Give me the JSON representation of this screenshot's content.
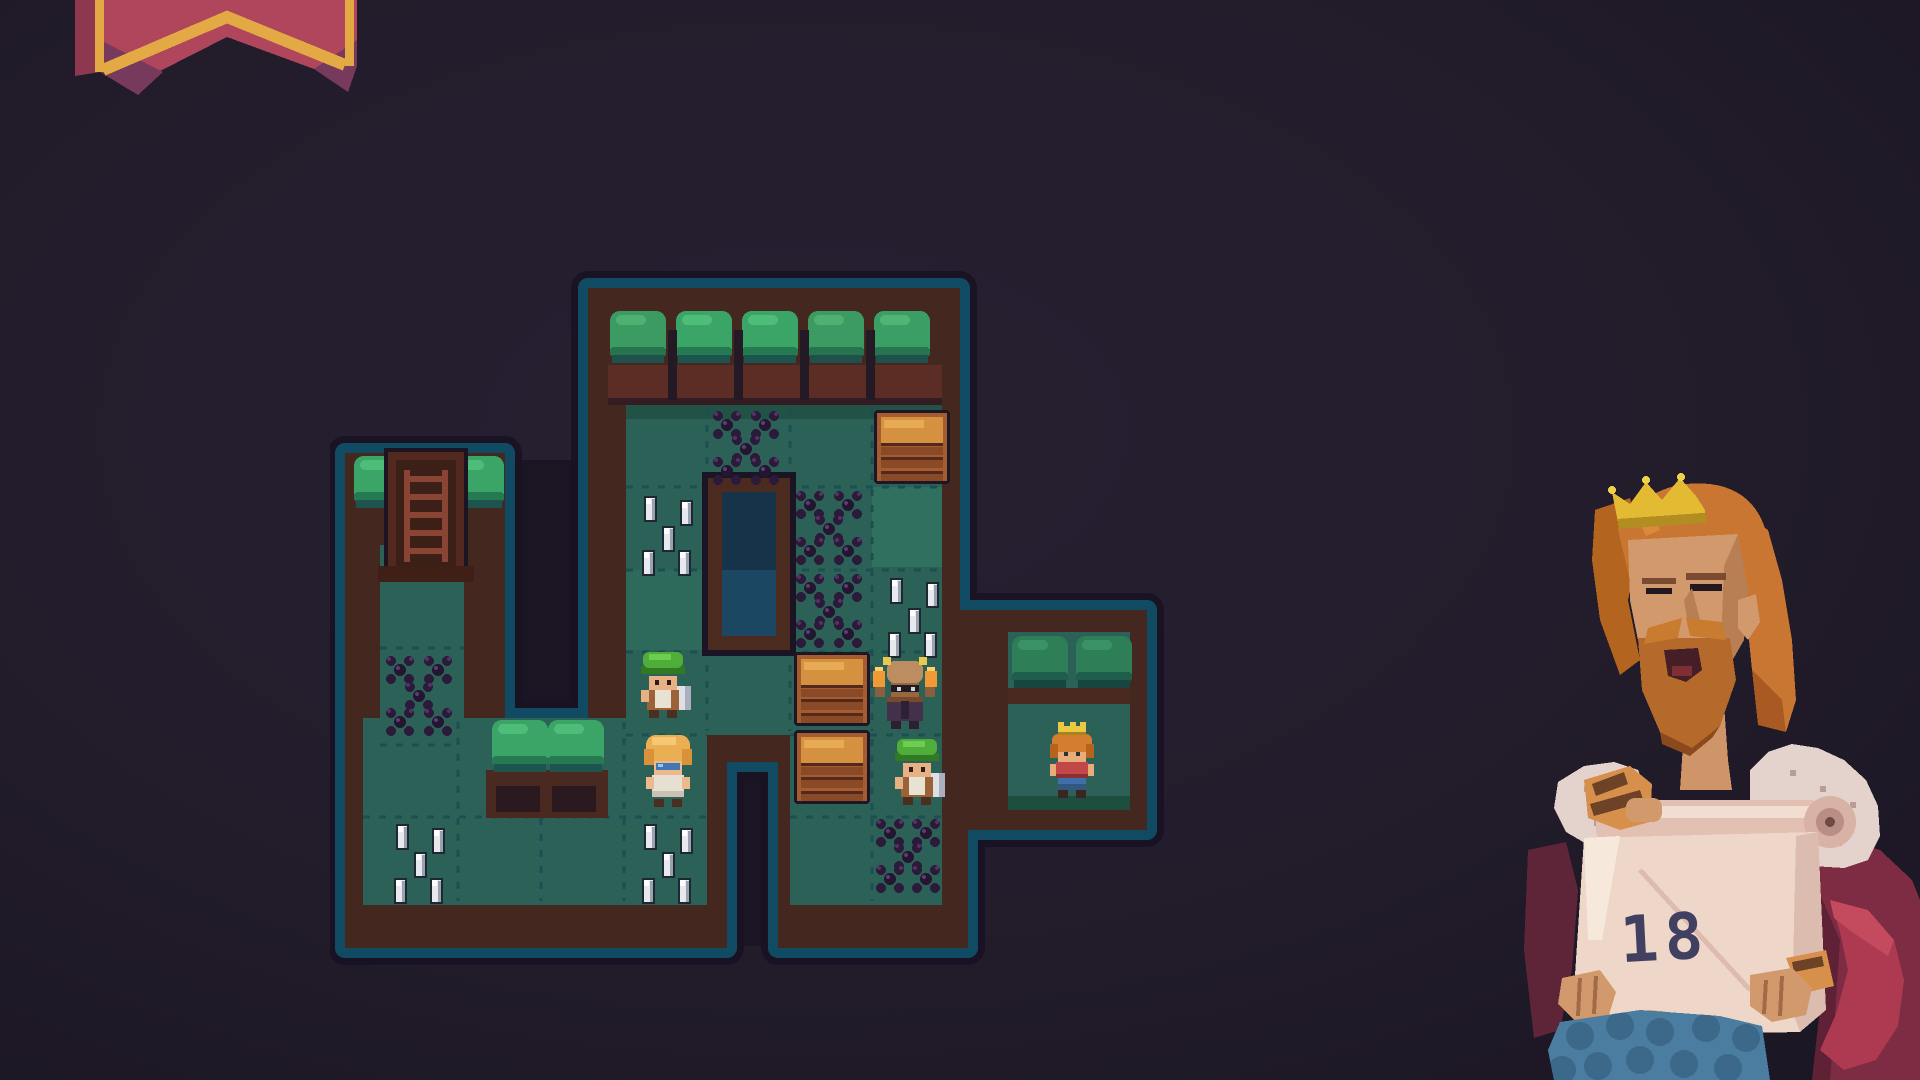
{
  "scene": {
    "description": "pixel-art puzzle game level with king presenting level number",
    "background_color": "#221c2b"
  },
  "banner": {
    "name": "hanging pennant",
    "body_color": "#b0465c",
    "trim_color": "#e3a944",
    "shadow_color": "#77395c"
  },
  "level": {
    "board_name": "puzzle-board",
    "tile_floor_color": "#2b6156",
    "wall_color": "#44281f",
    "border_color": "#114a63",
    "hedge_color": "#3ba568",
    "characters": [
      {
        "id": "miner-green-cap-left",
        "cap": "green",
        "carrying": "white sack"
      },
      {
        "id": "blond-miner",
        "hair": "blond",
        "goggles": "blue"
      },
      {
        "id": "torch-bearer",
        "torches": 2
      },
      {
        "id": "miner-green-cap-right",
        "cap": "green",
        "carrying": "white sack"
      },
      {
        "id": "little-king",
        "crown": "gold"
      }
    ],
    "props": {
      "crates": 3,
      "spike_patches": 4,
      "berry_patches": 5,
      "pits": 1,
      "ladders": 1
    }
  },
  "king": {
    "name": "king presenter",
    "crown_color": "#e2bb33",
    "hair_color": "#c87631",
    "robe_color": "#7e2b44",
    "scroll": {
      "number": "18"
    }
  }
}
